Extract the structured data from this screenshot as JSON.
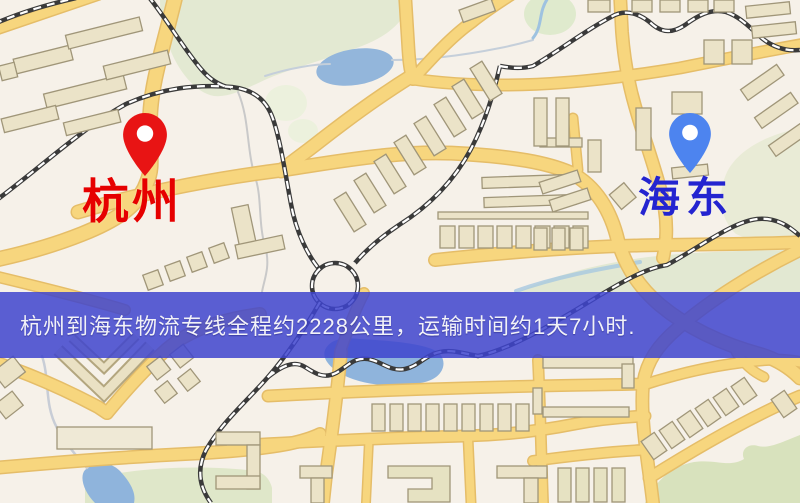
{
  "banner": {
    "text": "杭州到海东物流专线全程约2228公里，运输时间约1天7小时.",
    "bg_color": "rgba(62,68,206,0.85)",
    "text_color": "#f2f2f8"
  },
  "markers": {
    "origin": {
      "label": "杭州",
      "label_color": "#e60000",
      "pin_color": "#e81414"
    },
    "destination": {
      "label": "海东",
      "label_color": "#2424d0",
      "pin_color": "#4d84ef"
    }
  },
  "map": {
    "colors": {
      "background": "#f6f1e9",
      "road_fill": "#f7d67e",
      "road_casing": "#e5bd68",
      "park_green": "#e3e9d2",
      "water_blue": "#8fb4dc",
      "railway_dark": "#3a3a3a",
      "building_fill": "#ebe3c8",
      "building_outline": "#a09679"
    },
    "feature_types": [
      "roads",
      "railways",
      "water",
      "parks",
      "buildings",
      "streams"
    ]
  }
}
